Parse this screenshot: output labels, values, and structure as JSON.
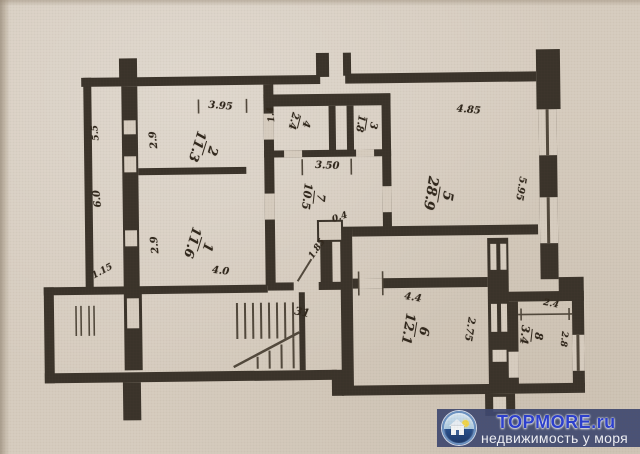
{
  "plan": {
    "room_fractions": [
      {
        "name": "room-2-label",
        "num": "2",
        "den": "11.3",
        "x": 205,
        "y": 147,
        "rot": 108,
        "fs": 13
      },
      {
        "name": "room-1-label",
        "num": "1",
        "den": "11.6",
        "x": 199,
        "y": 243,
        "rot": 108,
        "fs": 13
      },
      {
        "name": "room-5-label",
        "num": "5",
        "den": "28.9",
        "x": 439,
        "y": 196,
        "rot": 100,
        "fs": 14
      },
      {
        "name": "room-6-label",
        "num": "6",
        "den": "12.1",
        "x": 414,
        "y": 331,
        "rot": 100,
        "fs": 13
      },
      {
        "name": "room-8-label",
        "num": "8",
        "den": "3.4",
        "x": 530,
        "y": 338,
        "rot": 97,
        "fs": 11
      },
      {
        "name": "room-4-label",
        "num": "4",
        "den": "2.4",
        "x": 300,
        "y": 122,
        "rot": 105,
        "fs": 10
      },
      {
        "name": "room-3-label",
        "num": "3",
        "den": "1.8",
        "x": 367,
        "y": 125,
        "rot": 100,
        "fs": 10
      },
      {
        "name": "room-7-label",
        "num": "7",
        "den": "10.5",
        "x": 314,
        "y": 197,
        "rot": 97,
        "fs": 11
      }
    ],
    "dimensions": [
      {
        "text": "3.95",
        "x": 222,
        "y": 105,
        "rot": 5,
        "fs": 10
      },
      {
        "text": "2.9",
        "x": 155,
        "y": 138,
        "rot": -95,
        "fs": 10
      },
      {
        "text": "5.5",
        "x": 97,
        "y": 130,
        "rot": -95,
        "fs": 9
      },
      {
        "text": "6.0",
        "x": 98,
        "y": 196,
        "rot": -95,
        "fs": 10
      },
      {
        "text": "2.9",
        "x": 155,
        "y": 243,
        "rot": -95,
        "fs": 10
      },
      {
        "text": "1.15",
        "x": 102,
        "y": 269,
        "rot": -28,
        "fs": 9
      },
      {
        "text": "4.0",
        "x": 220,
        "y": 270,
        "rot": 8,
        "fs": 10
      },
      {
        "text": "1.4",
        "x": 273,
        "y": 114,
        "rot": -95,
        "fs": 9
      },
      {
        "text": "3.50",
        "x": 328,
        "y": 166,
        "rot": 3,
        "fs": 10
      },
      {
        "text": "0.4",
        "x": 340,
        "y": 218,
        "rot": -18,
        "fs": 9
      },
      {
        "text": "1.85",
        "x": 317,
        "y": 249,
        "rot": -55,
        "fs": 9
      },
      {
        "text": "4.85",
        "x": 470,
        "y": 112,
        "rot": 6,
        "fs": 10
      },
      {
        "text": "5.95",
        "x": 521,
        "y": 191,
        "rot": 100,
        "fs": 10
      },
      {
        "text": "4.4",
        "x": 412,
        "y": 299,
        "rot": 10,
        "fs": 10
      },
      {
        "text": "2.75",
        "x": 468,
        "y": 331,
        "rot": 100,
        "fs": 10
      },
      {
        "text": "2.4",
        "x": 550,
        "y": 307,
        "rot": 12,
        "fs": 9
      },
      {
        "text": "2.8",
        "x": 562,
        "y": 342,
        "rot": 97,
        "fs": 9
      },
      {
        "text": "31",
        "x": 301,
        "y": 312,
        "rot": 12,
        "fs": 11
      }
    ]
  },
  "watermark": {
    "brand": "TOPMORE.ru",
    "tagline": "недвижимость у моря"
  },
  "colors": {
    "paper": "#d8cec1",
    "wall": "#3a332a",
    "ink": "#2f261b",
    "watermark_band": "rgba(62,72,112,0.92)",
    "watermark_blue": "#2b3fd0",
    "watermark_text": "#f0f1f7"
  }
}
